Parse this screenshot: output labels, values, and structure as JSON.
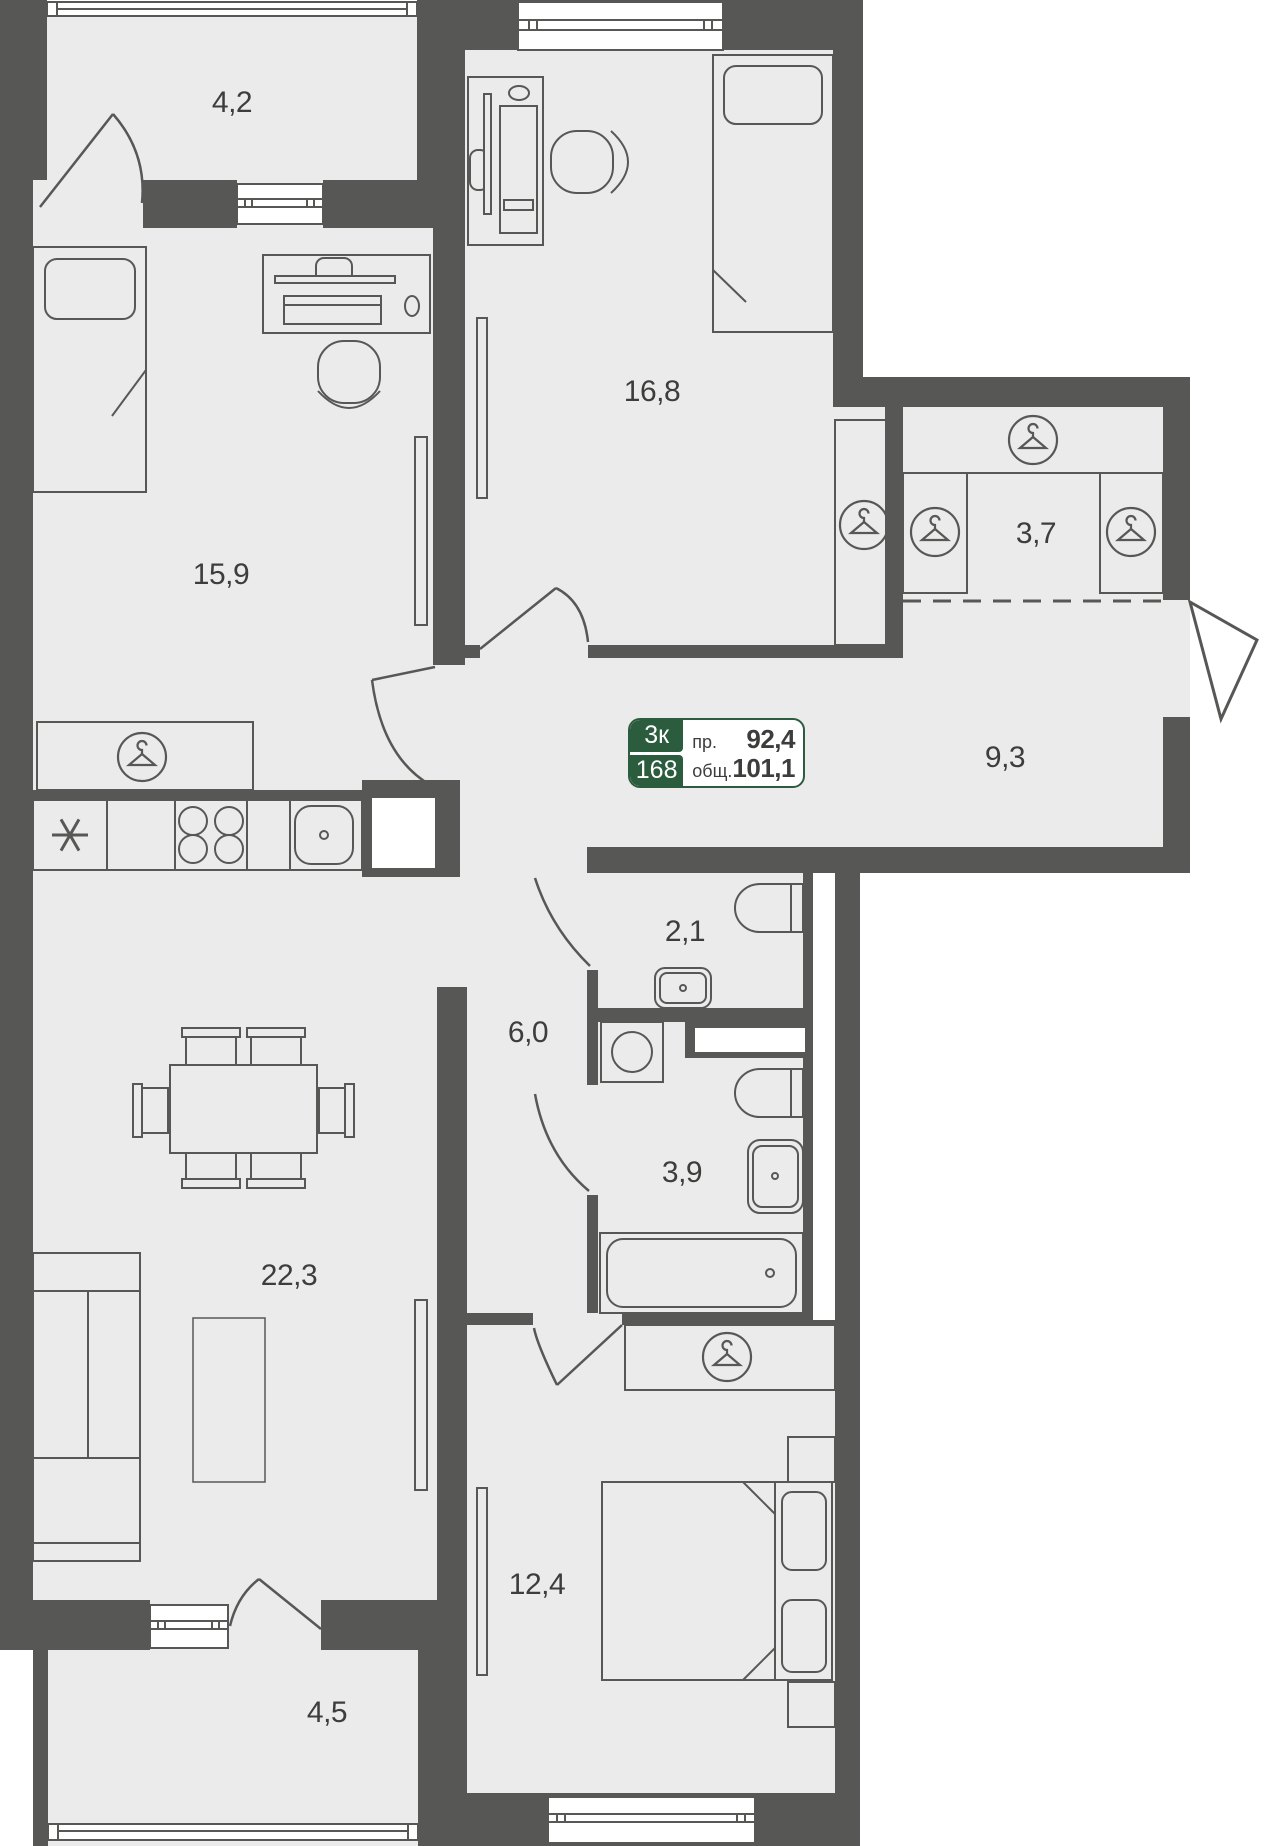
{
  "plan": {
    "info_card": {
      "rooms_short": "3к",
      "unit_number": "168",
      "projected_label": "пр.",
      "projected_area": "92,4",
      "total_label": "общ.",
      "total_area": "101,1"
    },
    "rooms": [
      {
        "name": "balcony-top",
        "area": "4,2"
      },
      {
        "name": "bedroom-left",
        "area": "15,9"
      },
      {
        "name": "bedroom-top",
        "area": "16,8"
      },
      {
        "name": "wardrobe",
        "area": "3,7"
      },
      {
        "name": "hallway",
        "area": "9,3"
      },
      {
        "name": "wc",
        "area": "2,1"
      },
      {
        "name": "corridor",
        "area": "6,0"
      },
      {
        "name": "bathroom",
        "area": "3,9"
      },
      {
        "name": "living-room",
        "area": "22,3"
      },
      {
        "name": "bedroom-bottom",
        "area": "12,4"
      },
      {
        "name": "balcony-bottom",
        "area": "4,5"
      }
    ],
    "colors": {
      "wall": "#575756",
      "floor": "#ebebeb",
      "outside": "#ffffff",
      "accent_green": "#2b5c3d",
      "label_text": "#3d3d3c"
    }
  }
}
